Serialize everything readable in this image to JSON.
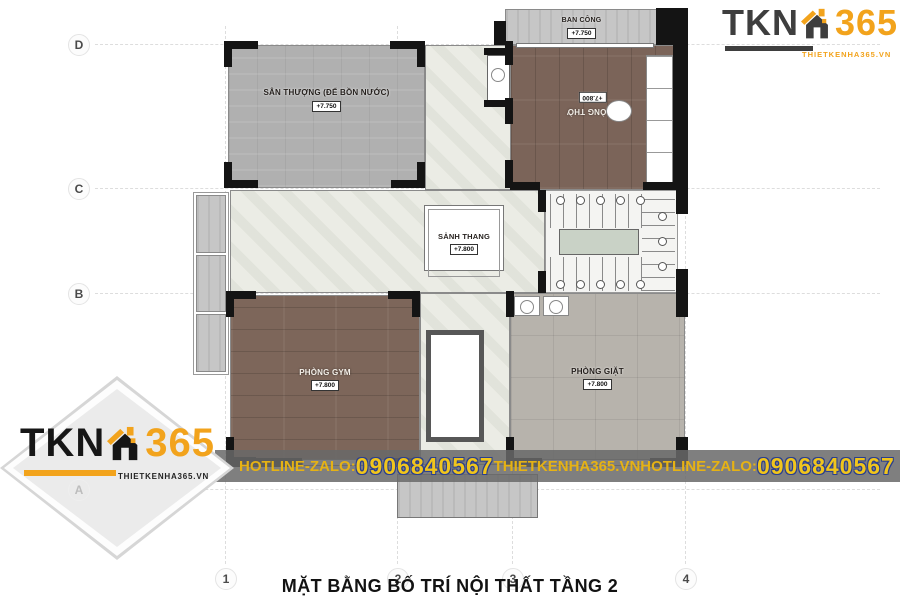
{
  "title": "MẶT BẰNG BỐ TRÍ NỘI THẤT TẦNG 2",
  "grid": {
    "rows": [
      "D",
      "C",
      "B",
      "A"
    ],
    "cols": [
      "1",
      "2",
      "3",
      "4"
    ]
  },
  "rooms": {
    "ban_cong": {
      "label": "BAN CÔNG",
      "level": "+7.750"
    },
    "san_thuong": {
      "label": "SÂN THƯỢNG (ĐỂ BỒN NƯỚC)",
      "level": "+7.750"
    },
    "phong_tho": {
      "label": "PHÒNG THỜ",
      "level": "+7.800"
    },
    "sanh_thang": {
      "label": "SẢNH THANG",
      "level": "+7.800"
    },
    "phong_gym": {
      "label": "PHÒNG GYM",
      "level": "+7.800"
    },
    "phong_giat": {
      "label": "PHÒNG GIẶT",
      "level": "+7.800"
    }
  },
  "hotline_bar": {
    "label1": "HOTLINE-ZALO:",
    "phone1": "0906840567",
    "website": "THIETKENHA365.VN",
    "label2": "HOTLINE-ZALO:",
    "phone2": "0906840567"
  },
  "logo": {
    "tkn": "TKN",
    "n365": "365",
    "website": "THIETKENHA365.VN"
  },
  "colors": {
    "brand_orange": "#F2A31C",
    "brand_dark": "#3E3E3E",
    "bar_yellow": "#E6B214",
    "phone_outline_navy": "#2A3F8F",
    "bar_gray": "#686868"
  }
}
